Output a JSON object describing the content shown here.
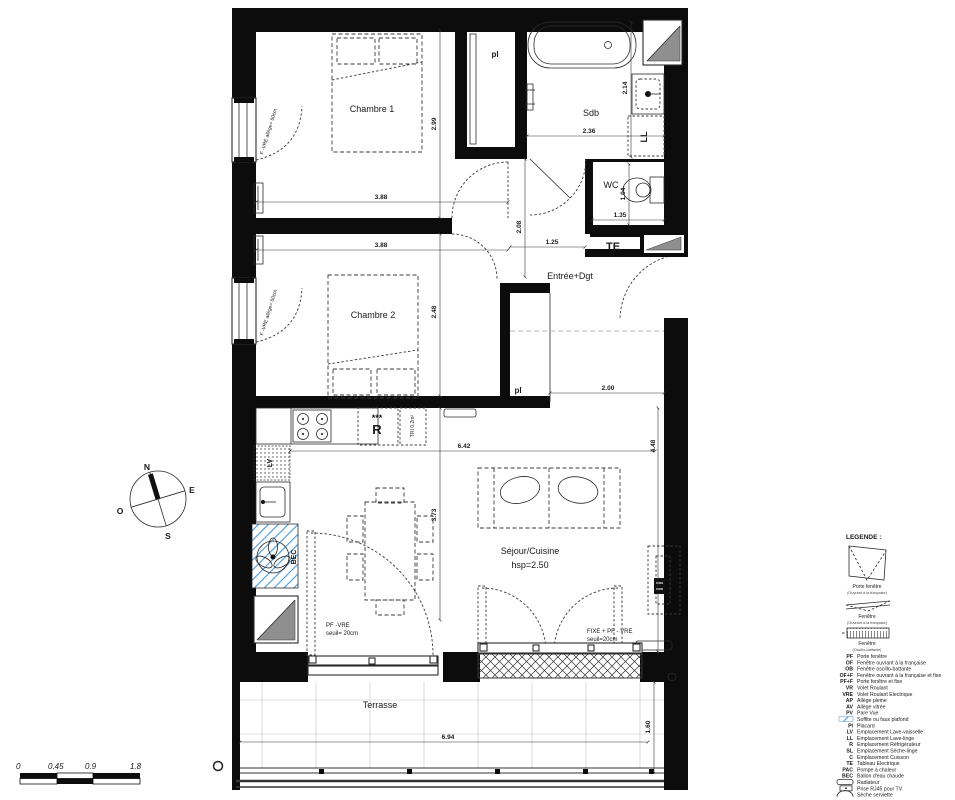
{
  "plan": {
    "texts": [
      {
        "t": "Chambre 1",
        "x": 372,
        "y": 112,
        "c": "room"
      },
      {
        "t": "Chambre 2",
        "x": 373,
        "y": 318,
        "c": "room"
      },
      {
        "t": "Sdb",
        "x": 591,
        "y": 116,
        "c": "room"
      },
      {
        "t": "WC",
        "x": 611,
        "y": 188,
        "c": "room"
      },
      {
        "t": "Entrée+Dgt",
        "x": 570,
        "y": 279,
        "c": "room"
      },
      {
        "t": "Séjour/Cuisine",
        "x": 530,
        "y": 554,
        "c": "room"
      },
      {
        "t": "hsp=2.50",
        "x": 530,
        "y": 568,
        "c": "room"
      },
      {
        "t": "Terrasse",
        "x": 380,
        "y": 708,
        "c": "room"
      },
      {
        "t": "pl",
        "x": 495,
        "y": 57,
        "c": "b8"
      },
      {
        "t": "pl",
        "x": 518,
        "y": 393,
        "c": "b8"
      },
      {
        "t": "TE",
        "x": 613,
        "y": 250,
        "c": "b11"
      },
      {
        "t": "R",
        "x": 377,
        "y": 434,
        "c": "b12"
      },
      {
        "t": "***",
        "x": 377,
        "y": 421,
        "c": "b9"
      },
      {
        "t": "TRI 0.2m²",
        "x": 414,
        "y": 426,
        "c": "tiny",
        "r": -90
      },
      {
        "t": "BEC",
        "x": 296,
        "y": 557,
        "c": "b7",
        "r": -90
      },
      {
        "t": "LV",
        "x": 272,
        "y": 463,
        "c": "b7",
        "r": -90
      },
      {
        "t": "LL",
        "x": 647,
        "y": 137,
        "c": "b9",
        "r": -90
      },
      {
        "t": "F -VRE allège= 60cm",
        "x": 270,
        "y": 132,
        "c": "tiny",
        "r": -73
      },
      {
        "t": "F -VRE allège= 60cm",
        "x": 270,
        "y": 313,
        "c": "tiny",
        "r": -73
      },
      {
        "t": "PF -VRE",
        "x": 326,
        "y": 627,
        "c": "small"
      },
      {
        "t": "seuil= 20cm",
        "x": 326,
        "y": 635,
        "c": "small"
      },
      {
        "t": "FIXE + PF - VRE",
        "x": 587,
        "y": 633,
        "c": "small"
      },
      {
        "t": "seuil=20cm",
        "x": 587,
        "y": 641,
        "c": "small"
      }
    ],
    "dims": [
      {
        "t": "3.88",
        "x": 381,
        "y": 199
      },
      {
        "t": "3.88",
        "x": 381,
        "y": 247
      },
      {
        "t": "2.99",
        "x": 436,
        "y": 124,
        "r": -90
      },
      {
        "t": "2.48",
        "x": 436,
        "y": 312,
        "r": -90
      },
      {
        "t": "3.73",
        "x": 436,
        "y": 515,
        "r": -90
      },
      {
        "t": "2.36",
        "x": 589,
        "y": 133
      },
      {
        "t": "2.14",
        "x": 627,
        "y": 88,
        "r": -90
      },
      {
        "t": "1.04",
        "x": 625,
        "y": 194,
        "r": -90
      },
      {
        "t": "1.35",
        "x": 620,
        "y": 217
      },
      {
        "t": "1.25",
        "x": 552,
        "y": 244
      },
      {
        "t": "2.08",
        "x": 521,
        "y": 227,
        "r": -90
      },
      {
        "t": "2.00",
        "x": 608,
        "y": 390
      },
      {
        "t": "6.42",
        "x": 464,
        "y": 448
      },
      {
        "t": "4.48",
        "x": 655,
        "y": 446,
        "r": -90
      },
      {
        "t": "6.94",
        "x": 448,
        "y": 739
      },
      {
        "t": "1.60",
        "x": 650,
        "y": 727,
        "r": -90
      }
    ],
    "compass": {
      "n": "N",
      "e": "E",
      "s": "S",
      "o": "O"
    },
    "scalebar": {
      "labels": [
        "0",
        "0.45",
        "0.9",
        "1.8"
      ]
    }
  },
  "legend": {
    "title": "LEGENDE :",
    "symbols": [
      {
        "label": "Porte fenêtre",
        "sub": "(Ouvrant à la française)"
      },
      {
        "label": "Fenêtre",
        "sub": "(Ouvrant à la française)"
      },
      {
        "label": "Fenêtre",
        "sub": "(Oscillo-battante)"
      }
    ],
    "items": [
      {
        "abbr": "PF",
        "label": "Porte fenêtre"
      },
      {
        "abbr": "OF",
        "label": "Fenêtre ouvrant à la française"
      },
      {
        "abbr": "OB",
        "label": "Fenêtre oscillo-battante"
      },
      {
        "abbr": "OF+F",
        "label": "Fenêtre ouvrant à la française et fixe"
      },
      {
        "abbr": "PF+F",
        "label": "Porte fenêtre et fixe"
      },
      {
        "abbr": "VR",
        "label": "Volet Roulant"
      },
      {
        "abbr": "VRE",
        "label": "Volet Roulant Electrique"
      },
      {
        "abbr": "AP",
        "label": "Allège pleine"
      },
      {
        "abbr": "AV",
        "label": "Allège vitrée"
      },
      {
        "abbr": "PV",
        "label": "Pare Vue"
      },
      {
        "sym": "soffite",
        "label": "Soffite ou faux plafond"
      },
      {
        "abbr": "Pl",
        "label": "Placard"
      },
      {
        "abbr": "LV",
        "label": "Emplacement Lave-vaisselle"
      },
      {
        "abbr": "LL",
        "label": "Emplacement Lave-linge"
      },
      {
        "abbr": "R",
        "label": "Emplacement Réfrigérateur"
      },
      {
        "abbr": "SL",
        "label": "Emplacement Sèche-linge"
      },
      {
        "abbr": "C",
        "label": "Emplacement Cuisson"
      },
      {
        "abbr": "TE",
        "label": "Tableau Electrique"
      },
      {
        "abbr": "PAC",
        "label": "Pompe à chaleur"
      },
      {
        "abbr": "BEC",
        "label": "Ballon d'eau chaude"
      },
      {
        "sym": "radiateur",
        "label": "Radiateur"
      },
      {
        "sym": "rj45",
        "label": "Prise RJ45 pour TV"
      },
      {
        "sym": "seche",
        "label": "Sèche serviette"
      }
    ],
    "colors": {
      "soffite_blue": "#4a9ada",
      "wall_black": "#0c0c0c",
      "shaft_gray": "#8f8f8f"
    }
  }
}
